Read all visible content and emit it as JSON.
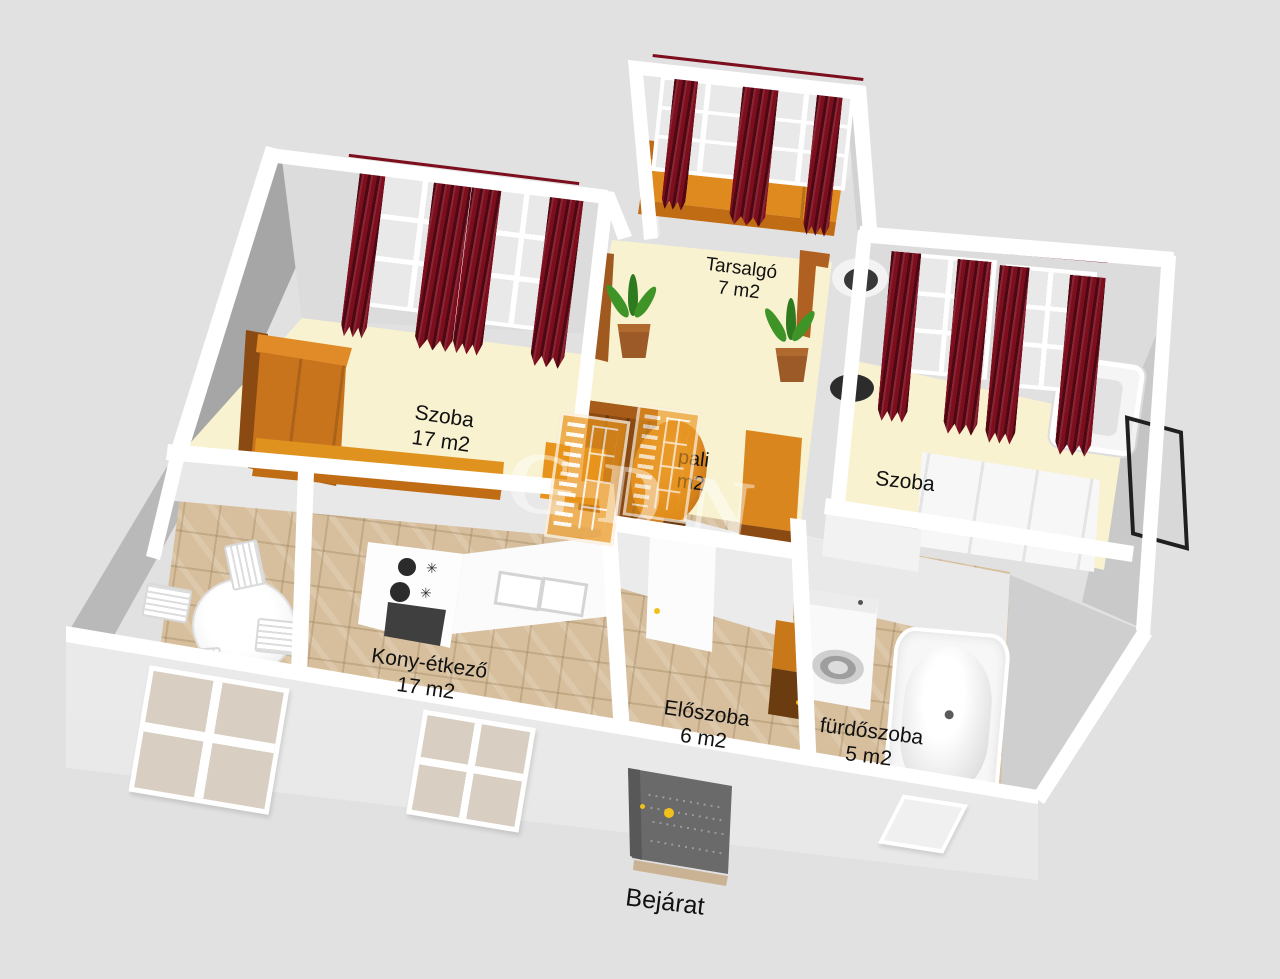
{
  "colors": {
    "bg": "#e1e1e1",
    "wall_face": "#dcdcdc",
    "wall_mid": "#b9b9b9",
    "wall_dark": "#a6a6a6",
    "wall_top": "#ffffff",
    "floor_cream": "#f8f2d0",
    "floor_tile": "#d7bf9d",
    "curtain": "#7c0e1e",
    "wood_orange": "#df8a1f",
    "wood_mid": "#c06c14",
    "wood_dark": "#8a4a12",
    "wood_brown": "#6b3c10",
    "door_gray": "#6a6a6a",
    "handle_yellow": "#f0c11a",
    "plant_green": "#3f9428",
    "pot_brown": "#9c5a28",
    "lamp_black": "#2b2b2b",
    "text": "#111111",
    "watermark_orange": "#e8941c"
  },
  "rooms": {
    "tarsalgo": {
      "name": "Tarsalgó",
      "area": "7 m2"
    },
    "szoba_bal": {
      "name": "Szoba",
      "area": "17 m2"
    },
    "nappali": {
      "name_visible": "pali",
      "area_visible": "m2"
    },
    "szoba_jobb": {
      "name": "Szoba"
    },
    "konyha": {
      "name": "Kony-étkező",
      "area": "17 m2"
    },
    "eloszoba": {
      "name": "Előszoba",
      "area": "6 m2"
    },
    "furdoszoba": {
      "name": "fürdőszoba",
      "area": "5 m2"
    }
  },
  "entrance": {
    "label": "Bejárat"
  },
  "watermark": {
    "letters": "GDN"
  },
  "icons": {
    "hob_star": "✳"
  }
}
